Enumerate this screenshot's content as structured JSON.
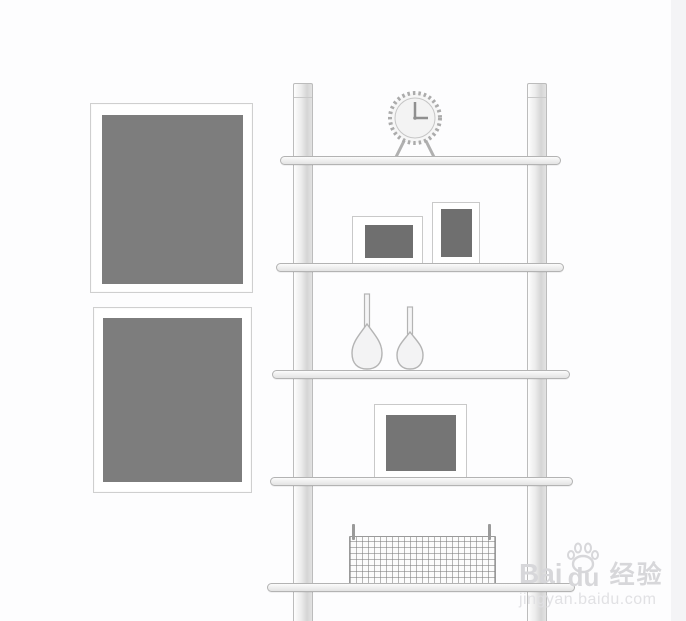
{
  "meta": {
    "type": "illustration",
    "description": "Line-sketch of a five-tier ladder wall shelf decorated with a clock, photo frames, vases and a wire basket, next to two framed grey pictures"
  },
  "palette": {
    "background": "#fdfdfe",
    "right_strip": "#f4f4f6",
    "sketch_line": "#b3b3b3",
    "wall_frame_art": "#7d7d7d",
    "shelf_frame_art": "#6f6f6f",
    "watermark_text": "#d7d7da",
    "watermark_url": "#e1e1e4"
  },
  "wall_pictures": {
    "count": 2
  },
  "shelf_unit": {
    "posts": 2,
    "shelves": 5,
    "items": {
      "clock": {
        "time": "3:00"
      },
      "shelf2_frames": 2,
      "shelf3_vases": 2,
      "shelf4_frames": 1,
      "shelf5_baskets": 1
    }
  },
  "watermark": {
    "brand_prefix": "Bai",
    "brand_suffix": "du",
    "brand_cn": "经验",
    "url": "jingyan.baidu.com"
  }
}
